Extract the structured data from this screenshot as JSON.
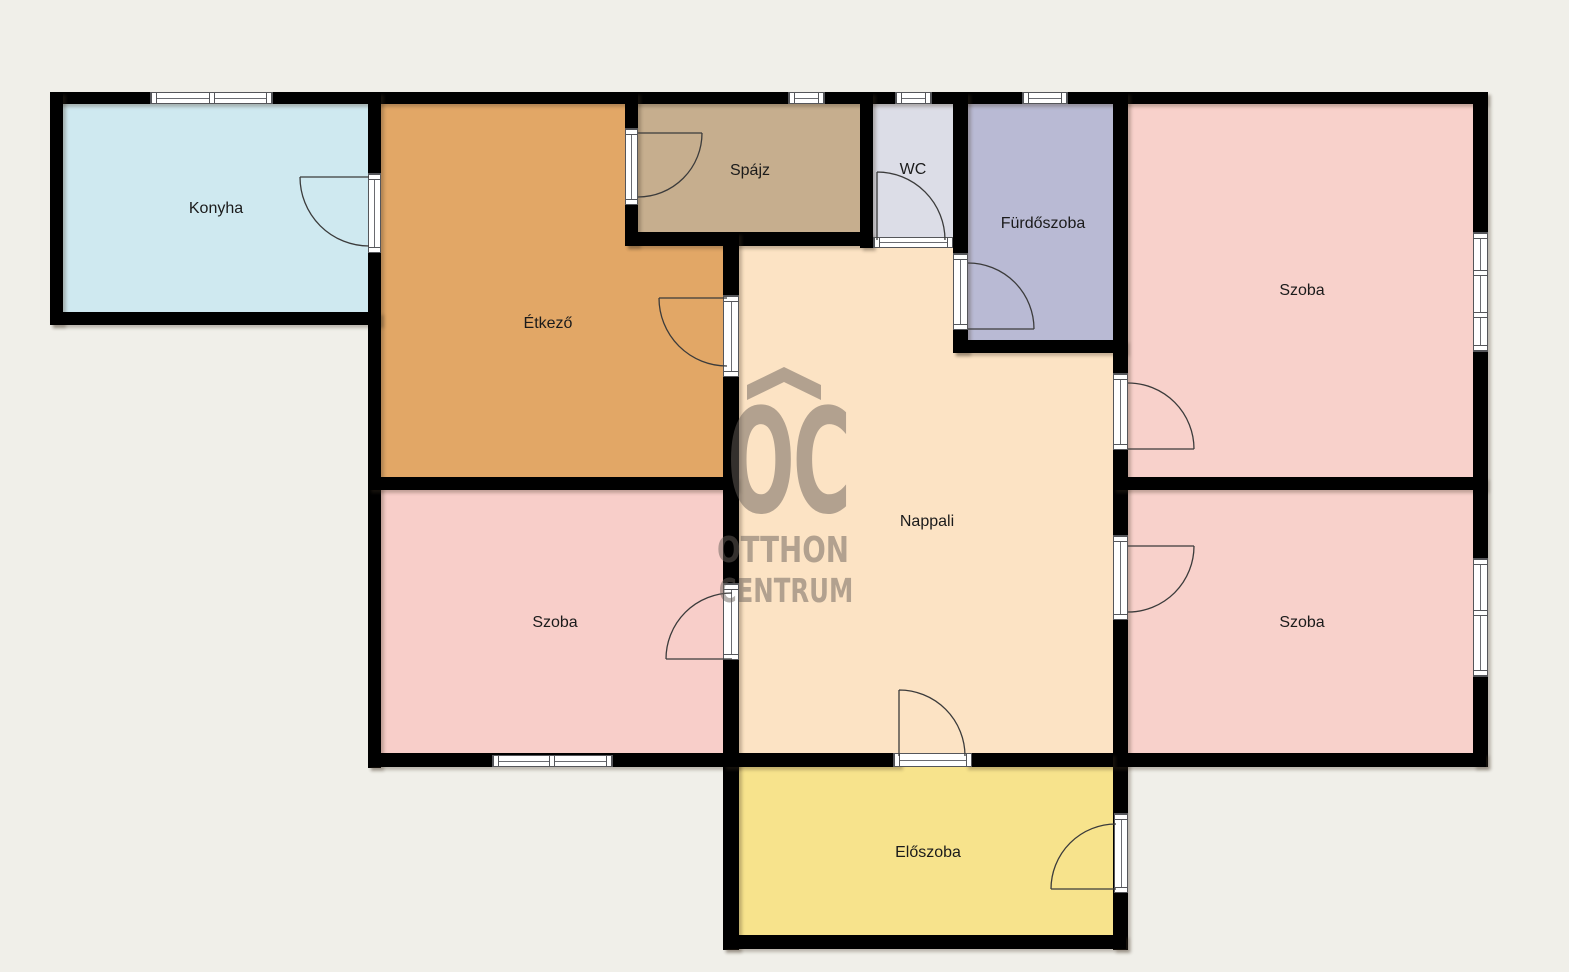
{
  "page": {
    "background": "#f0efe9"
  },
  "colors": {
    "wall": "#000000",
    "door_stroke": "#3b3b3b",
    "frame_border": "#55565a",
    "label_text": "#1b1b1b"
  },
  "watermark": {
    "monogram": "OC",
    "line1": "OTTHON",
    "line2": "CENTRUM",
    "color": "rgba(104,96,89,0.5)"
  },
  "rooms": [
    {
      "id": "konyha",
      "label": "Konyha",
      "color": "#cfe9f0"
    },
    {
      "id": "etkezo",
      "label": "Étkező",
      "color": "#e2a766"
    },
    {
      "id": "spajz",
      "label": "Spájz",
      "color": "#c6ae8e"
    },
    {
      "id": "wc",
      "label": "WC",
      "color": "#dcdde7"
    },
    {
      "id": "furdoszoba",
      "label": "Fürdőszoba",
      "color": "#b9bad4"
    },
    {
      "id": "szoba-felso",
      "label": "Szoba",
      "color": "#f8d1cb"
    },
    {
      "id": "nappali",
      "label": "Nappali",
      "color": "#fce3c4"
    },
    {
      "id": "szoba-also-bal",
      "label": "Szoba",
      "color": "#f8cec9"
    },
    {
      "id": "szoba-also-jobb",
      "label": "Szoba",
      "color": "#f8d1cb"
    },
    {
      "id": "eloszoba",
      "label": "Előszoba",
      "color": "#f7e38c"
    }
  ]
}
